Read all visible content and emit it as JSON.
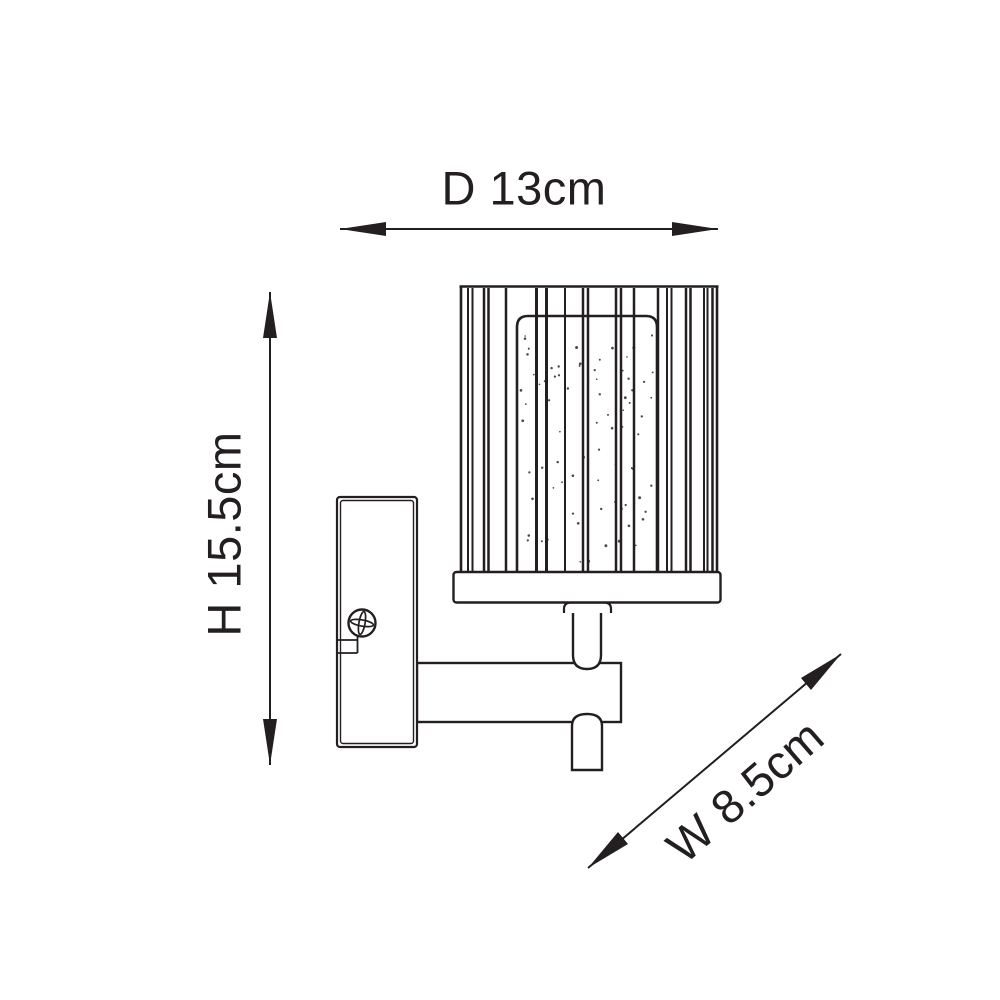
{
  "diagram": {
    "type": "product-dimension-line-drawing",
    "labels": {
      "depth": "D 13cm",
      "height": "H 15.5cm",
      "width": "W 8.5cm"
    },
    "dimensions": {
      "depth_cm": 13,
      "height_cm": 15.5,
      "width_cm": 8.5
    },
    "colors": {
      "line": "#231f20",
      "background": "#ffffff"
    },
    "parts": [
      "ribbed-cylindrical-shade",
      "inner-glass-diffuser",
      "shade-base-plate",
      "collar",
      "stem",
      "bracket-arm",
      "wall-plate",
      "mounting-screw"
    ]
  }
}
